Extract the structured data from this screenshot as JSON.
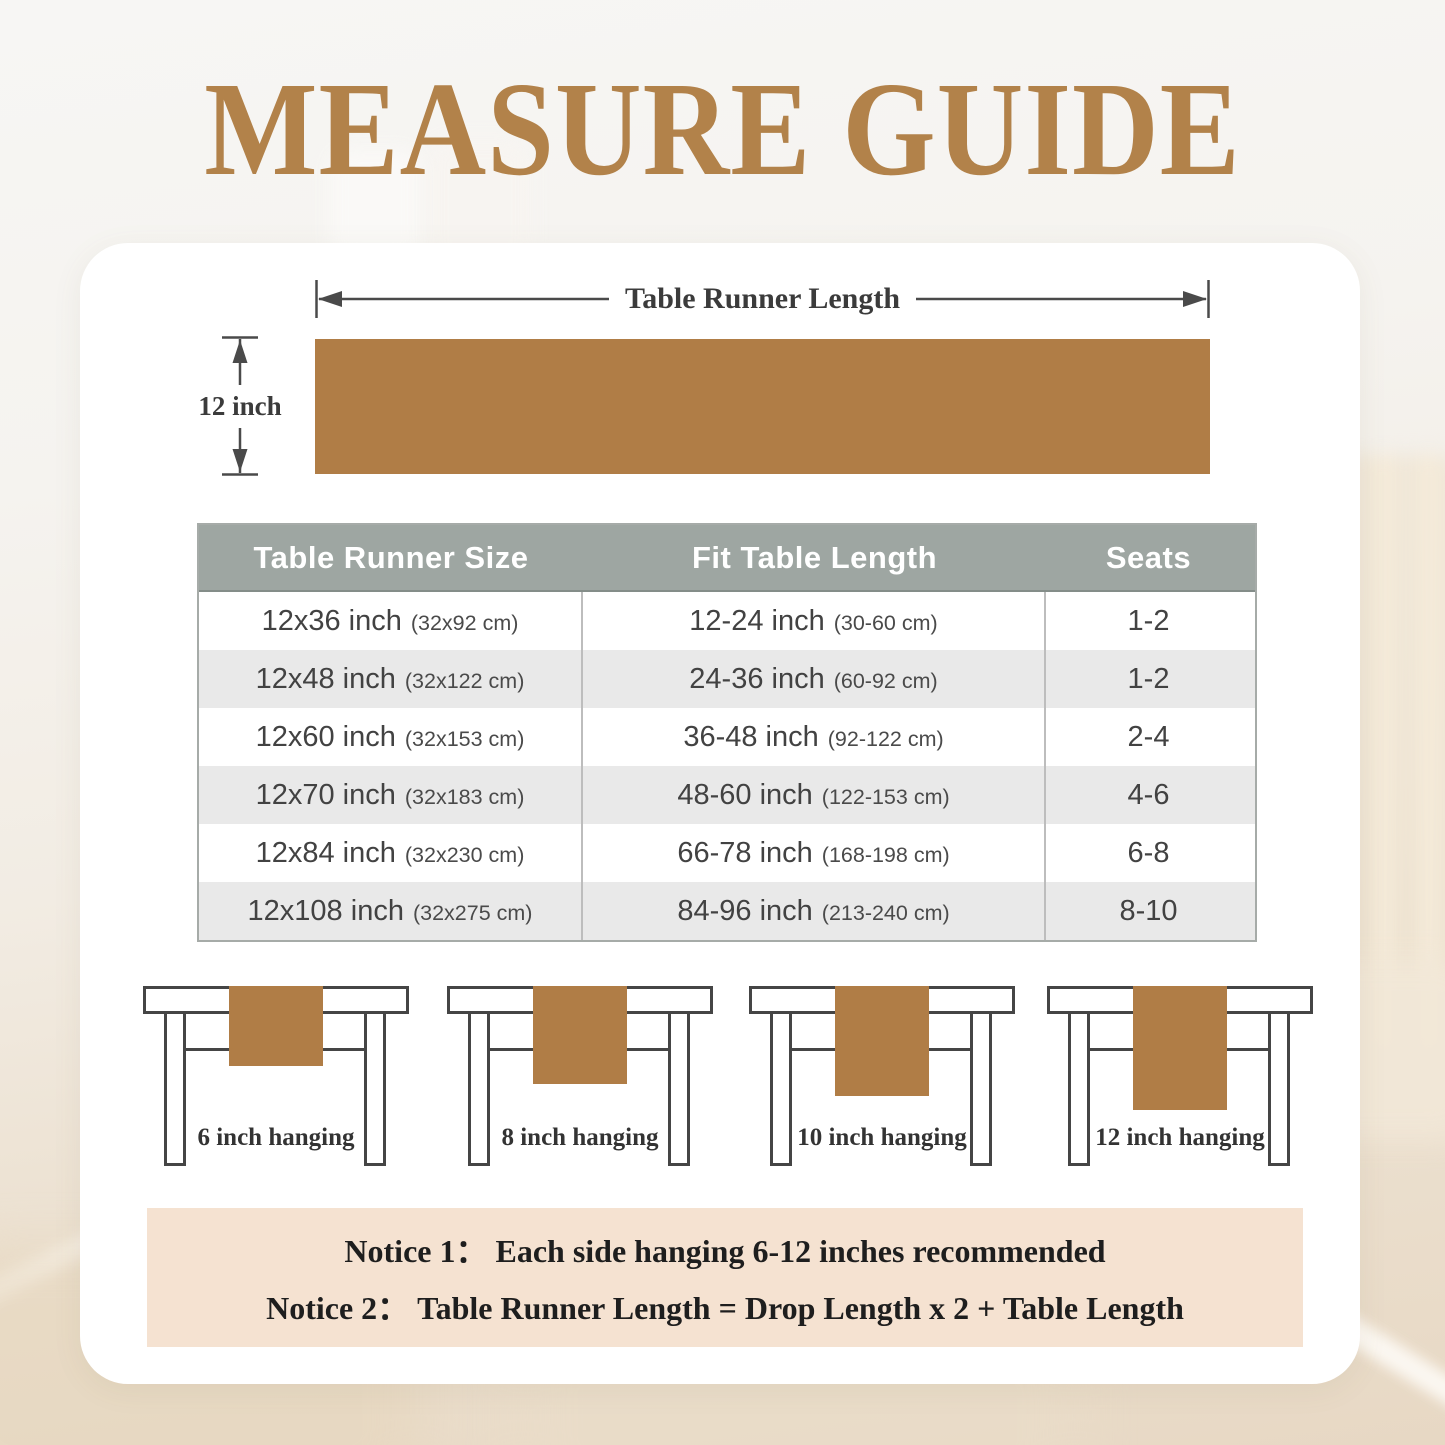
{
  "title": "MEASURE GUIDE",
  "diagram": {
    "length_label": "Table Runner Length",
    "width_label": "12 inch"
  },
  "size_table": {
    "headers": [
      "Table Runner Size",
      "Fit Table Length",
      "Seats"
    ],
    "rows": [
      {
        "size": "12x36 inch",
        "size_cm": "(32x92 cm)",
        "fit": "12-24 inch",
        "fit_cm": "(30-60 cm)",
        "seats": "1-2"
      },
      {
        "size": "12x48 inch",
        "size_cm": "(32x122 cm)",
        "fit": "24-36 inch",
        "fit_cm": "(60-92 cm)",
        "seats": "1-2"
      },
      {
        "size": "12x60 inch",
        "size_cm": "(32x153 cm)",
        "fit": "36-48 inch",
        "fit_cm": "(92-122 cm)",
        "seats": "2-4"
      },
      {
        "size": "12x70 inch",
        "size_cm": "(32x183 cm)",
        "fit": "48-60 inch",
        "fit_cm": "(122-153 cm)",
        "seats": "4-6"
      },
      {
        "size": "12x84 inch",
        "size_cm": "(32x230 cm)",
        "fit": "66-78 inch",
        "fit_cm": "(168-198 cm)",
        "seats": "6-8"
      },
      {
        "size": "12x108 inch",
        "size_cm": "(32x275 cm)",
        "fit": "84-96 inch",
        "fit_cm": "(213-240 cm)",
        "seats": "8-10"
      }
    ]
  },
  "hanging_examples": [
    {
      "label": "6 inch hanging"
    },
    {
      "label": "8 inch hanging"
    },
    {
      "label": "10 inch hanging"
    },
    {
      "label": "12 inch hanging"
    }
  ],
  "notices": [
    {
      "label": "Notice 1：",
      "text": "Each side hanging 6-12 inches recommended"
    },
    {
      "label": "Notice 2：",
      "text": "Table Runner Length = Drop Length x 2 + Table Length"
    }
  ],
  "colors": {
    "runner_brown": "#b07d46",
    "title_brown": "#b2824a",
    "table_header_gray": "#9ea6a2",
    "row_alt_gray": "#e9e9e9",
    "notice_beige": "#f5e2d1",
    "outline_gray": "#454545"
  }
}
